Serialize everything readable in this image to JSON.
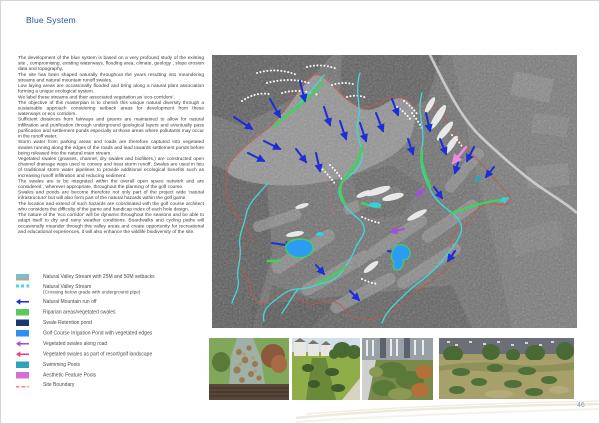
{
  "page": {
    "title": "Blue System",
    "title_color": "#2b4ea8",
    "page_number": "46"
  },
  "body": {
    "paragraphs": [
      "The development of the blue system is based on a very profound study of the existing site , compromising, existing waterways, flooding area, climate, geology , slope erosion data and topography.",
      "The site has been shaped naturally throughout the years resulting into meandering streams and natural mountain runoff swales.",
      "Low laying areas are occasionally flooded and bring along a natural plant association forming a unique ecological system.",
      "We label these streams and their associated vegetation as 'eco-corridors'.",
      "The objective of this masterplan is to cherish this unique natural diversity through a sustainable approach considering setback areas for development from these waterways or eco corridors.",
      "Sufficient distances from fairways and greens are maintained to allow for natural infiltration and purification through underground geological layers and eventually pass purification and settlement ponds especially at those areas where pollutants may occur in the runoff water.",
      "Storm water from parking areas and roads are therefore captured into vegetated swales running along the edges of the roads and lead towards settlement ponds before being released into the natural main stream.",
      "Vegetated swales (grasses, channel, dry swales and biofilters,) are constructed open channel drainage ways used to convey and treat storm runoff. Swales are used in lieu of traditional storm water pipelines to provide additional ecological benefits such as increasing runoff infiltration and reducing sediment.",
      "The swales are to be integrated within the overall open space network and are considered , wherever appropriate, throughout the planning of the golf course.",
      "Swales and ponds are become therefore not only part of the project wide 'natural infrastructure' but will also form part of the natural hazards within the golf game.",
      "The location and extend of such hazards are coordinated with the golf course architect who considers the difficulty of the game and handicap index of each hole design.",
      "The nature of the 'eco corridor' will be dynamic throughout the seasons and be able to adapt itself to dry and rainy weather conditions. Boardwalks and cycling paths will occasionally meander through this valley areas and create opportunity for recreational and educational experiences, it will also enhance the wildlife biodiversity of the site."
    ]
  },
  "legend": {
    "items": [
      {
        "label": "Natural Valley Stream with 25M and 50M setbacks",
        "color": "#49d7e2",
        "color2": "#f08878",
        "swatch": "striped"
      },
      {
        "label": "Natural Valley Stream",
        "sublabel": "(Crossing below grade with underground pipe)",
        "color": "#49d7e2",
        "swatch": "dashes"
      },
      {
        "label": "Natural Mountain run off",
        "color": "#1b2fd6",
        "swatch": "arrow"
      },
      {
        "label": "Riparian areas/vegetated swales",
        "color": "#5dc85a",
        "swatch": "rect"
      },
      {
        "label": "Swale Retention pond",
        "color": "#16396e",
        "swatch": "rect"
      },
      {
        "label": "Golf Course Irrigation Pond with vegetated edges",
        "color": "#2d8ff0",
        "swatch": "rect"
      },
      {
        "label": "Vegetated swales along road",
        "color": "#a44fd8",
        "swatch": "arrow"
      },
      {
        "label": "Vegetated swales as part of resort/golf landscape",
        "color": "#e8447e",
        "swatch": "arrow"
      },
      {
        "label": "Swimming Pools",
        "color": "#2fa3b5",
        "swatch": "rect"
      },
      {
        "label": "Aesthetic Feature Pools",
        "color": "#d56fd5",
        "swatch": "rect"
      },
      {
        "label": "Site Boundary",
        "color": "#f08878",
        "swatch": "line"
      }
    ]
  },
  "map": {
    "description_colors": {
      "stream": "#3fd9d9",
      "swale": "#44cf5e",
      "runoff_arrow": "#1b2fd6",
      "irrigation_pond": "#2b9cf2",
      "site_boundary": "#c3574a",
      "road": "#cfcfcf",
      "road_swale_arrow": "#a44fd8",
      "feature_arrow": "#ea8ce0"
    }
  }
}
